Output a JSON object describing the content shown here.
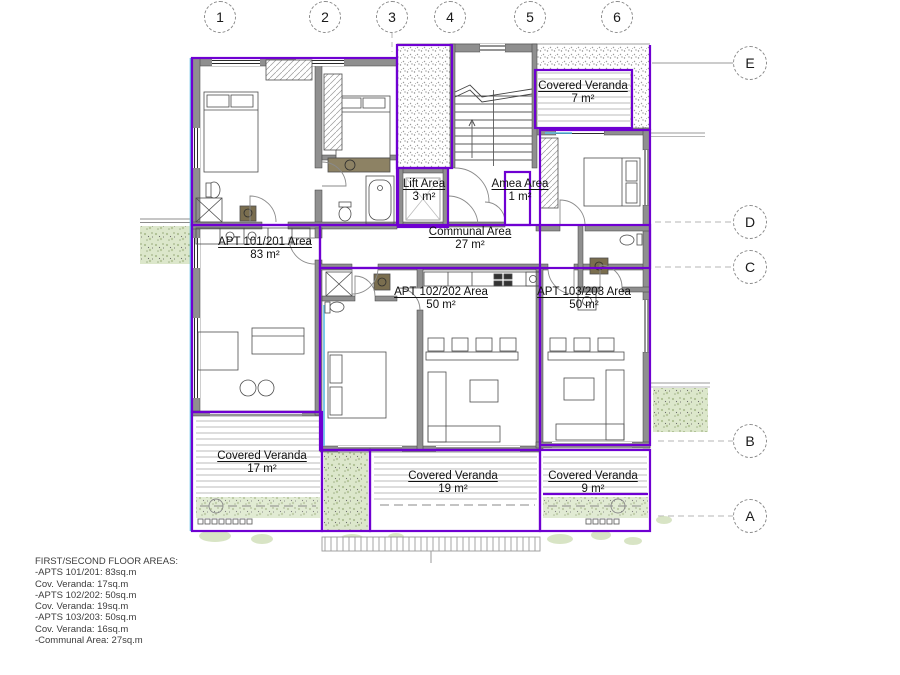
{
  "drawing_title": "FIRST/SECOND FLOOR AREAS:",
  "colors": {
    "unit_boundary_purple": "#6f00d2",
    "wall_gray": "#8f8f8f",
    "planting_green": "#dce7cb",
    "window_cyan": "#5bbde4",
    "counter_olive": "#7a6e4f"
  },
  "grid": {
    "columns": [
      "1",
      "2",
      "3",
      "4",
      "5",
      "6"
    ],
    "rows": [
      "E",
      "D",
      "C",
      "B",
      "A"
    ]
  },
  "rooms": [
    {
      "name": "APT 101/201 Area",
      "area": "83 m²"
    },
    {
      "name": "Communal Area",
      "area": "27 m²"
    },
    {
      "name": "Lift Area",
      "area": "3 m²"
    },
    {
      "name": "Amea Area",
      "area": "1 m²"
    },
    {
      "name": "Covered Veranda",
      "area": "7 m²"
    },
    {
      "name": "APT 102/202 Area",
      "area": "50 m²"
    },
    {
      "name": "APT 103/203 Area",
      "area": "50 m²"
    },
    {
      "name": "Covered Veranda",
      "area": "17 m²"
    },
    {
      "name": "Covered Veranda",
      "area": "19 m²"
    },
    {
      "name": "Covered Veranda",
      "area": "9 m²"
    }
  ],
  "summary": {
    "title": "FIRST/SECOND FLOOR AREAS:",
    "lines": [
      "-APTS 101/201: 83sq.m",
      "Cov. Veranda: 17sq.m",
      "-APTS 102/202: 50sq.m",
      "Cov. Veranda: 19sq.m",
      "-APTS 103/203: 50sq.m",
      "Cov. Veranda: 16sq.m",
      "-Communal Area: 27sq.m"
    ]
  }
}
